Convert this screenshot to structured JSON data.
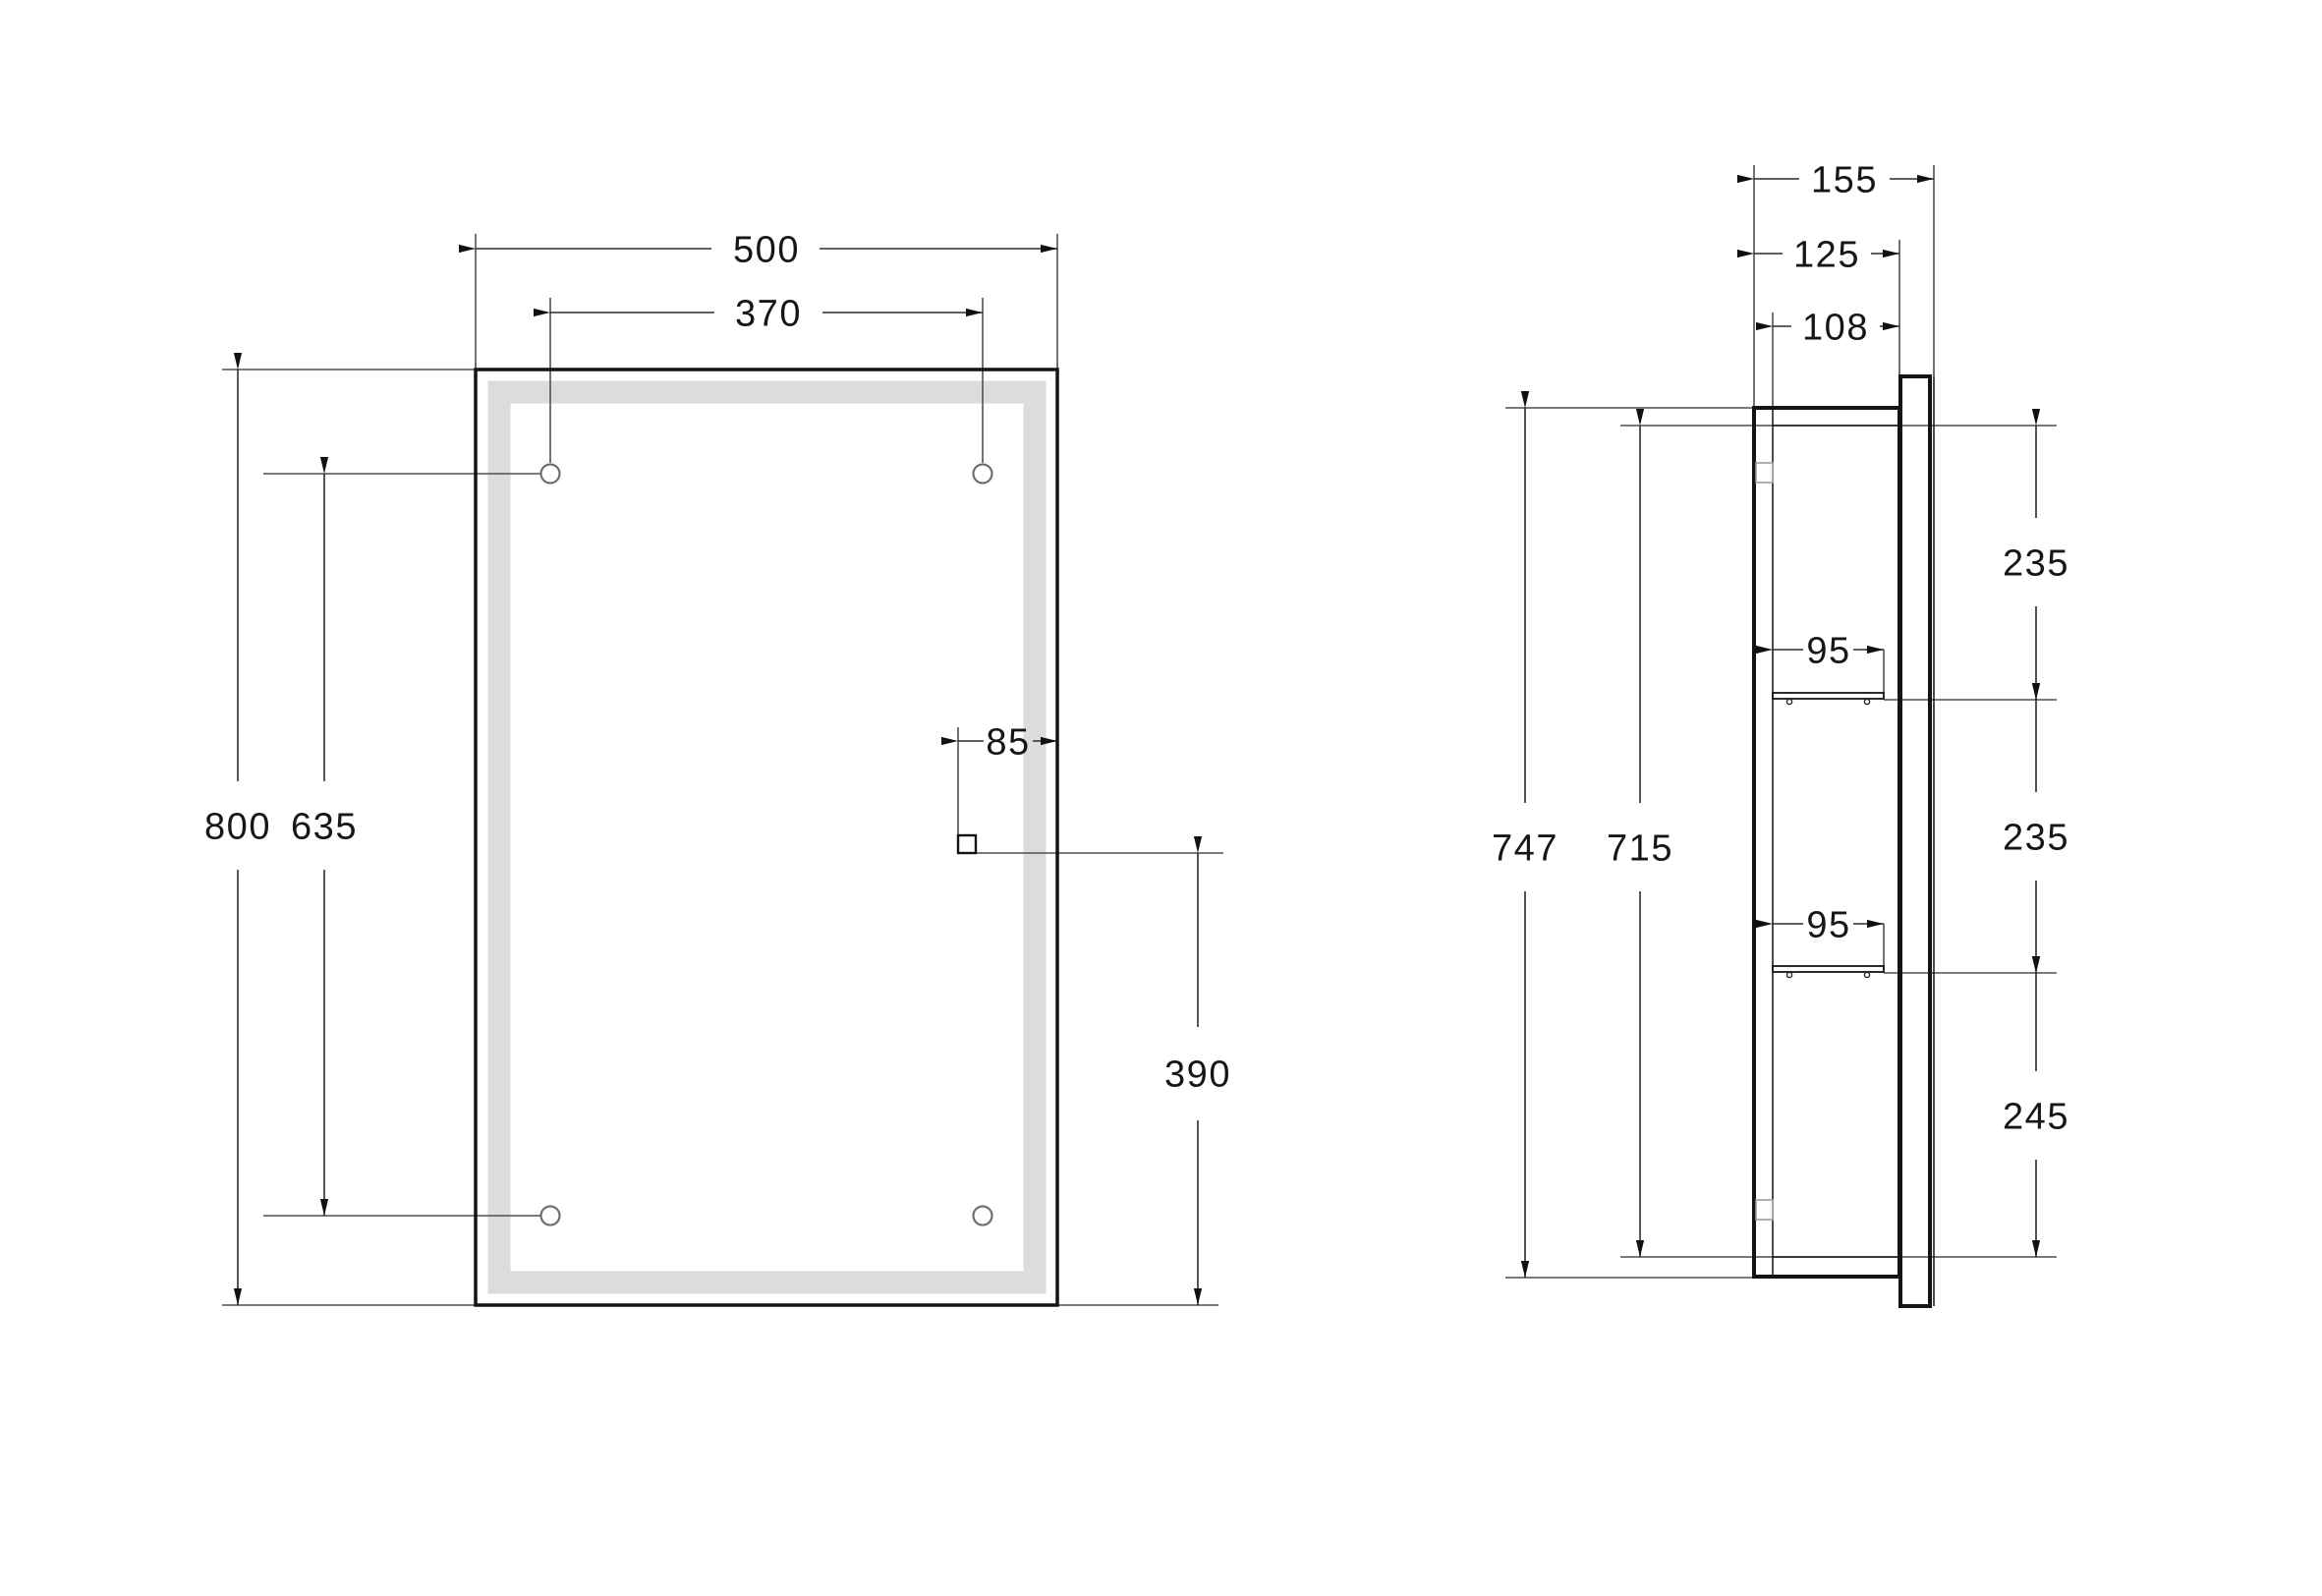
{
  "front_view": {
    "overall_width": "500",
    "hole_spacing_horizontal": "370",
    "overall_height": "800",
    "hole_spacing_vertical": "635",
    "switch_offset_from_right": "85",
    "switch_height_from_bottom": "390"
  },
  "side_view": {
    "overall_depth": "155",
    "cabinet_depth": "125",
    "inner_depth": "108",
    "overall_height": "747",
    "inner_height": "715",
    "top_compartment_height": "235",
    "upper_shelf_depth": "95",
    "middle_compartment_height": "235",
    "lower_shelf_depth": "95",
    "bottom_compartment_height": "245"
  },
  "colors": {
    "background": "#ffffff",
    "object_line": "#141414",
    "dimension_line": "#2b2b2b",
    "extension_line": "#4f4f4f",
    "led_strip": "#dcdcdc",
    "hole_outline": "#6e6e6e"
  }
}
